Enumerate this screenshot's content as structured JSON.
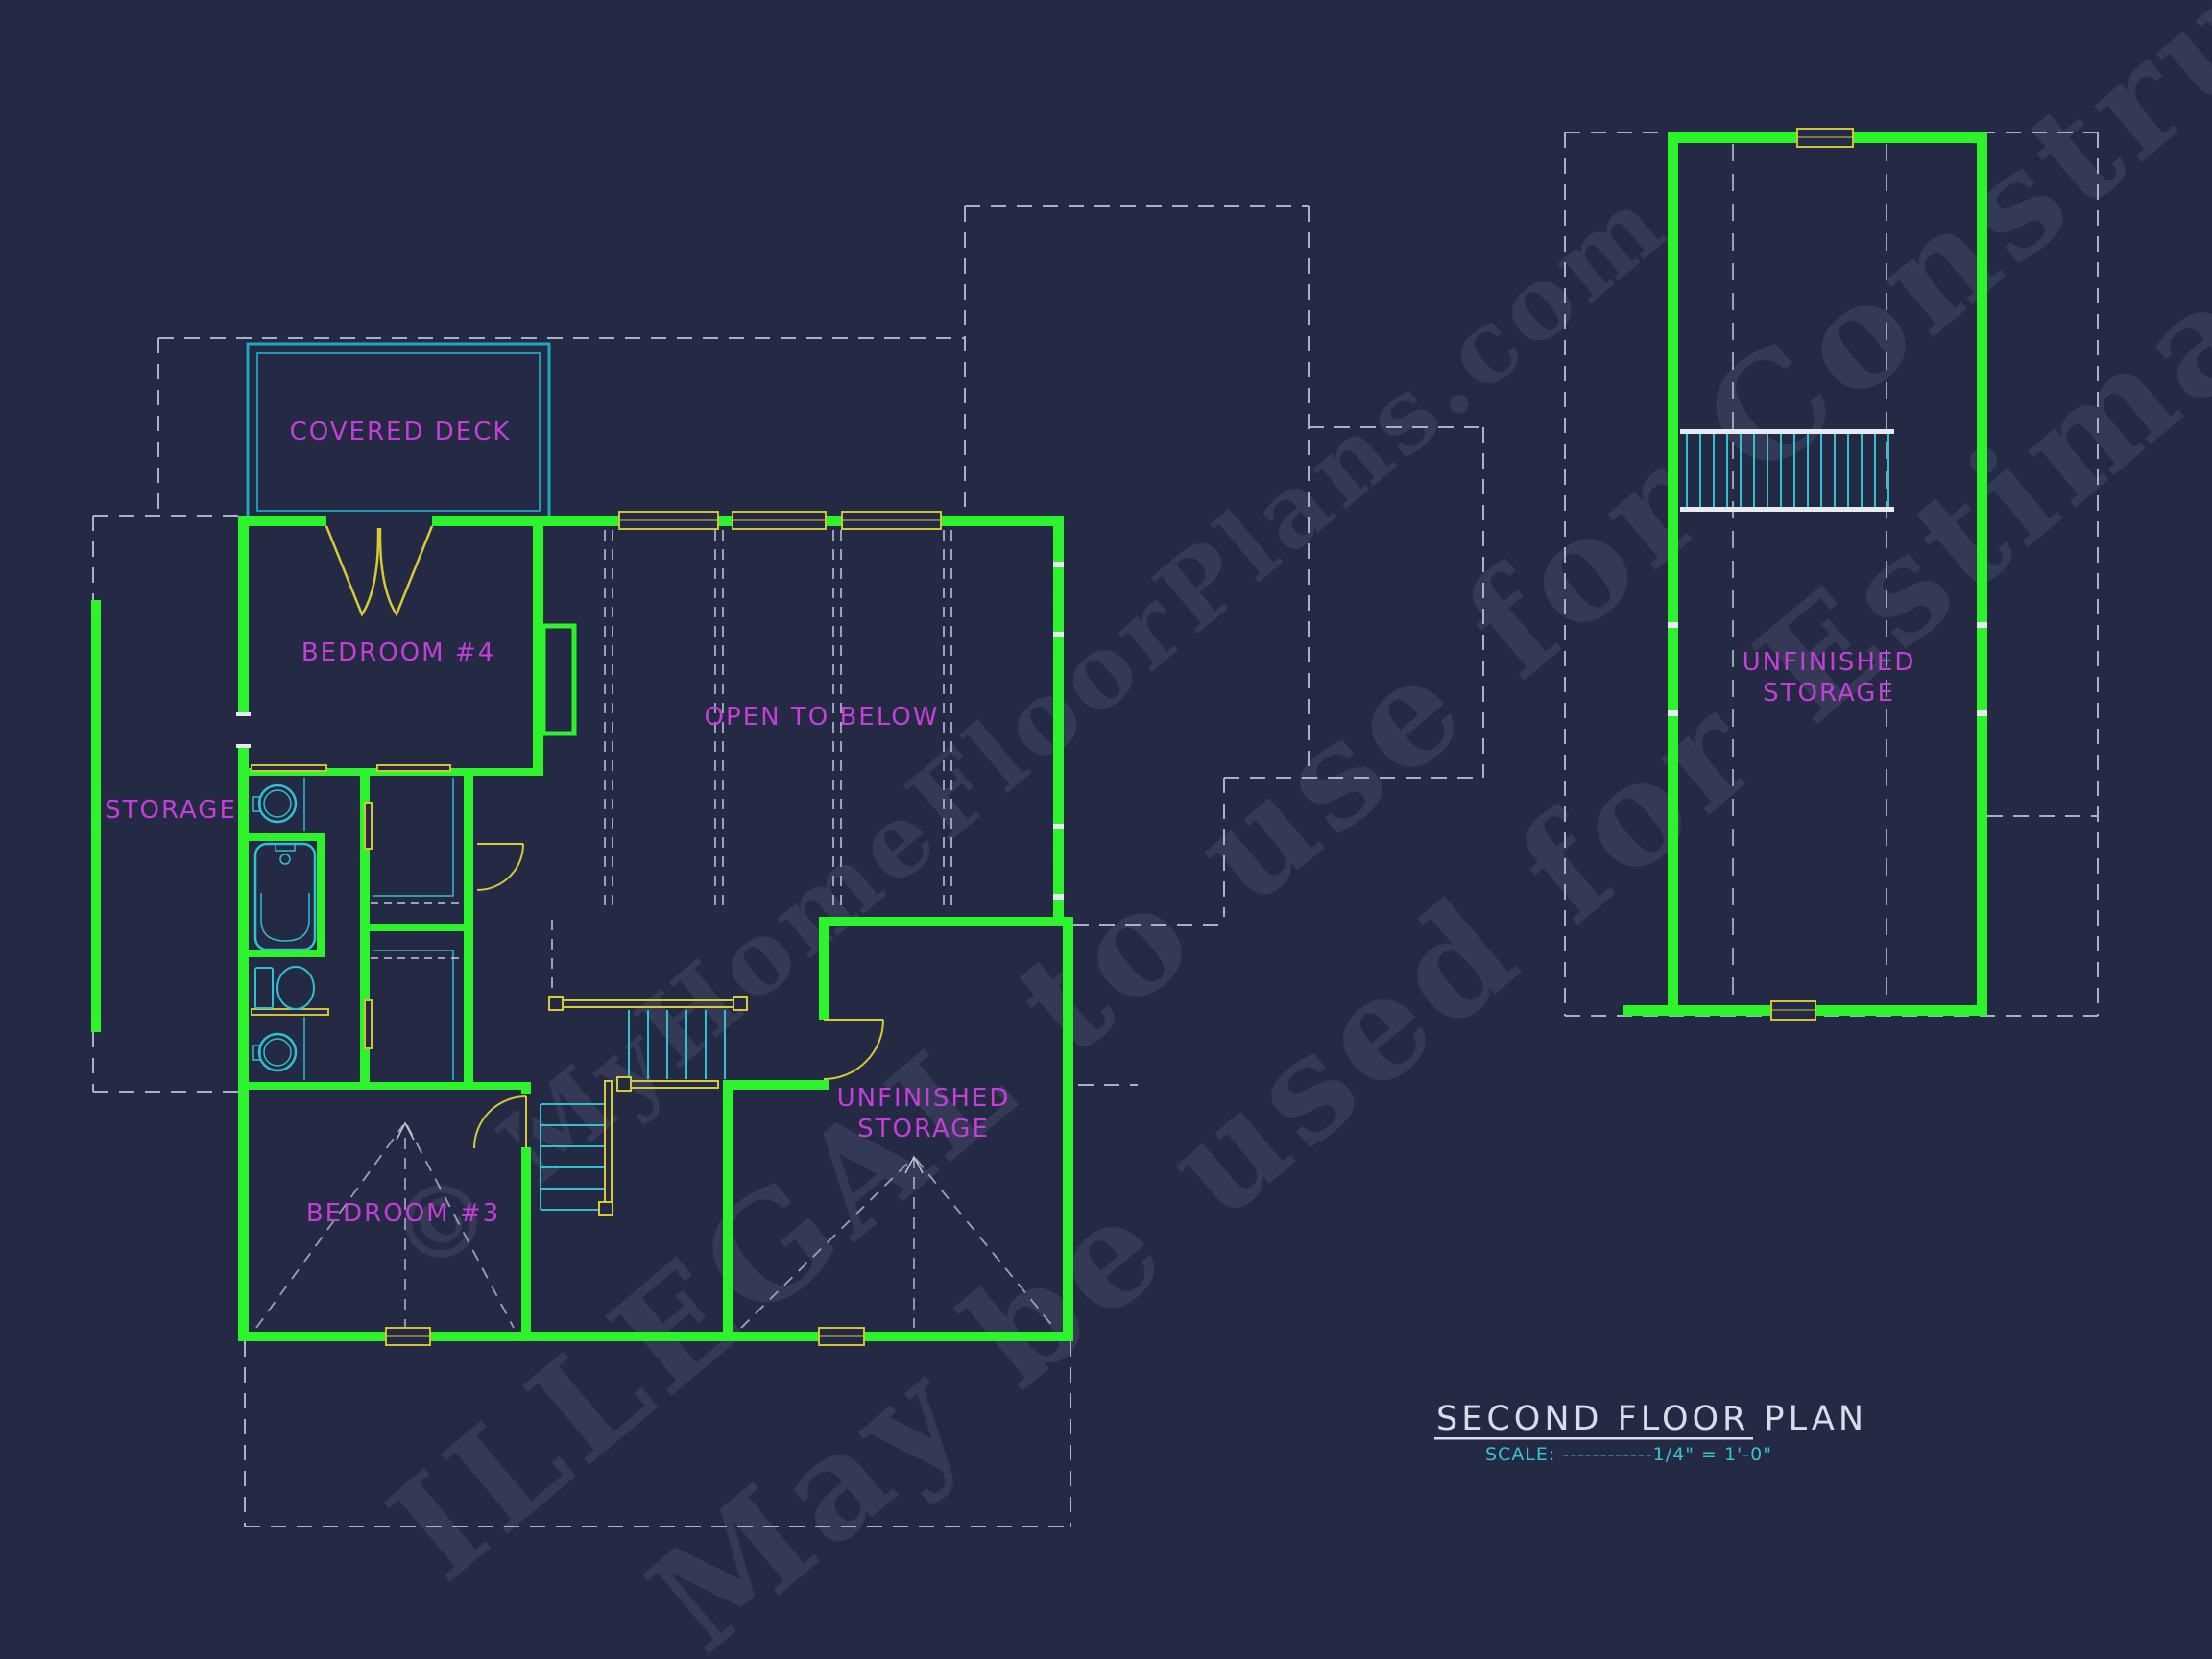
{
  "title_block": {
    "title": "SECOND FLOOR PLAN",
    "scale_label": "SCALE: ------------1/4\" = 1'-0\""
  },
  "rooms": {
    "covered_deck": "COVERED DECK",
    "bedroom_4": "BEDROOM #4",
    "storage_left": "STORAGE",
    "open_to_below": "OPEN TO BELOW",
    "bedroom_3": "BEDROOM #3",
    "unfinished_center_l1": "UNFINISHED",
    "unfinished_center_l2": "STORAGE",
    "unfinished_right_l1": "UNFINISHED",
    "unfinished_right_l2": "STORAGE"
  },
  "watermark": {
    "line1": "© MyHomeFloorPlans.com",
    "line2": "ILLEGAL to use for Construction",
    "line3": "May be used for Estimations"
  },
  "colors": {
    "background": "#242a44",
    "wall_green": "#2cf32c",
    "fixture_cyan": "#2fc0d2",
    "deck_cyan": "#1fa6bd",
    "label_magenta": "#c43ed8",
    "trim_yellow": "#d7ca36",
    "window_yellow": "#cfc233",
    "dash_gray": "#a9b1c7",
    "title_white": "#d9ddeb",
    "scale_cyan": "#36c2d4"
  }
}
